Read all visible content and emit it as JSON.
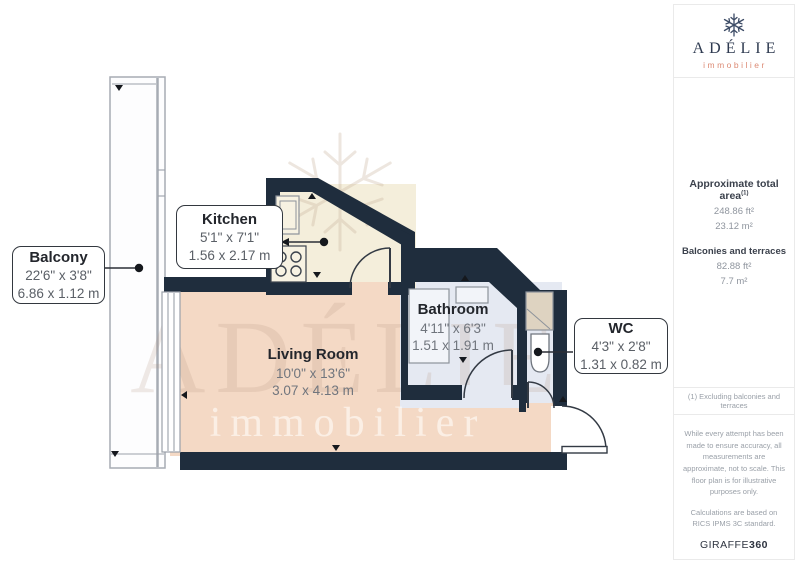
{
  "plan": {
    "rooms": {
      "balcony": {
        "name": "Balcony",
        "imperial": "22'6\" x 3'8\"",
        "metric": "6.86 x 1.12 m"
      },
      "kitchen": {
        "name": "Kitchen",
        "imperial": "5'1\" x 7'1\"",
        "metric": "1.56 x 2.17 m"
      },
      "living_room": {
        "name": "Living Room",
        "imperial": "10'0\" x 13'6\"",
        "metric": "3.07 x 4.13 m"
      },
      "bathroom": {
        "name": "Bathroom",
        "imperial": "4'11\" x 6'3\"",
        "metric": "1.51 x 1.91 m"
      },
      "wc": {
        "name": "WC",
        "imperial": "4'3\" x 2'8\"",
        "metric": "1.31 x 0.82 m"
      }
    },
    "watermark": {
      "line1": "ADÉLIE",
      "line2": "immobilier"
    }
  },
  "sidebar": {
    "logo": {
      "name": "ADÉLIE",
      "subtitle": "immobilier"
    },
    "areas": {
      "total_label": "Approximate total area",
      "total_sup": "(1)",
      "total_ft": "248.86 ft²",
      "total_m": "23.12 m²",
      "balconies_label": "Balconies and terraces",
      "balconies_ft": "82.88 ft²",
      "balconies_m": "7.7 m²"
    },
    "footnote": "(1) Excluding balconies and terraces",
    "disclaimer": "While every attempt has been made to ensure accuracy, all measurements are approximate, not to scale. This floor plan is for illustrative purposes only.",
    "standard": "Calculations are based on RICS IPMS 3C standard.",
    "brand": "GIRAFFE",
    "brand_bold": "360"
  },
  "colors": {
    "wall": "#1f2d3d",
    "living_floor": "#f4d9c5",
    "kitchen_floor": "#f4eedb",
    "bathroom_floor": "#e5e9f2",
    "balcony_stroke": "#a7acb4",
    "logo_navy": "#2e3a50",
    "logo_salmon": "#dc8a74"
  }
}
